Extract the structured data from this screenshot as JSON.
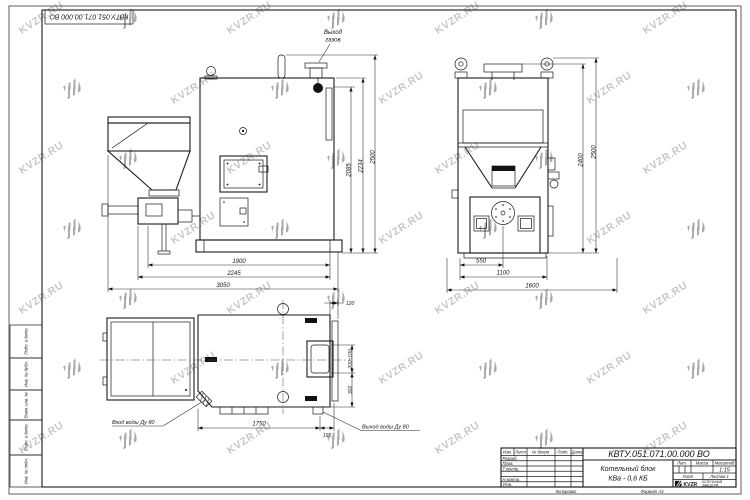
{
  "watermark": {
    "text": "KVZR.RU"
  },
  "stamp": {
    "doc_number": "КВТУ.051.071.00.000 ВО",
    "corner_doc_number": "КВТУ.051.071.00.000 ВО",
    "product_title_1": "Котельный блок",
    "product_title_2": "КВа - 0,6 КБ",
    "lit_label": "Лит.",
    "mass_label": "Масса",
    "scale_label": "Масштаб",
    "scale_value": "1:15",
    "sheet_label": "Лист",
    "sheets_label": "Листов 1",
    "copied_label": "Копировал",
    "format_label": "Формат А3",
    "logo_text": "KVZR",
    "logo_caption_1": "КОТЕЛЬНЫЙ",
    "logo_caption_2": "ЗАВОД РФ",
    "header_cols": {
      "izm": "Изм.",
      "list": "Лист",
      "docnum": "№ докум.",
      "podp": "Подп.",
      "data": "Дата"
    },
    "sig_rows": {
      "r1": "Разраб.",
      "r2": "Пров.",
      "r3": "Т.контр.",
      "r4": "",
      "r5": "Н.контр.",
      "r6": "Утв."
    }
  },
  "margin": {
    "m1": "Подп. и дата",
    "m2": "Инв. № дубл.",
    "m3": "Взам. инв. №",
    "m4": "Подп. и дата",
    "m5": "Инв. № подл."
  },
  "annotations": {
    "gas_outlet_line1": "Выход",
    "gas_outlet_line2": "газов",
    "water_inlet": "Вход воды Ду 80",
    "water_outlet": "Выход воды Ду 80"
  },
  "dims": {
    "front_h_2085": "2085",
    "front_h_2234": "2234",
    "front_h_2500": "2500",
    "front_w_1900": "1900",
    "front_w_2245": "2245",
    "front_w_3050": "3050",
    "side_h_2400": "2400",
    "side_h_2500": "2500",
    "side_w_550": "550",
    "side_w_1100": "1100",
    "side_w_1600": "1600",
    "top_w_1750": "1750",
    "top_w_195": "195",
    "top_d_120": "120",
    "top_d_200": "200±100",
    "top_d_302": "302"
  }
}
